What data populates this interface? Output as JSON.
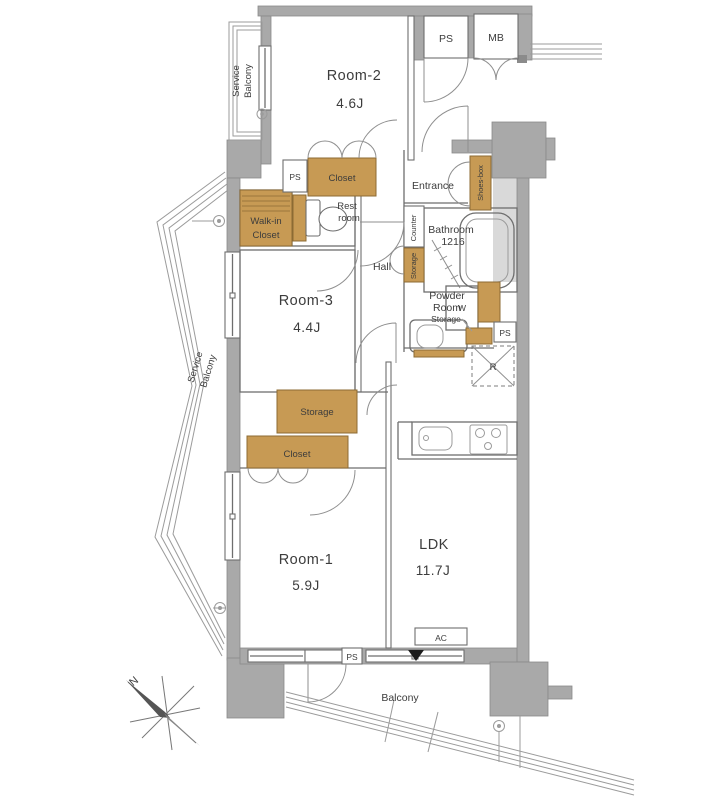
{
  "app": {
    "type": "apartment-floor-plan"
  },
  "colors": {
    "wall": "#a9a9a9",
    "wallStroke": "#8a8a8a",
    "line": "#6e6e6e",
    "fixture": "#c79a54",
    "fixtureStroke": "#8c6b33",
    "exterior": "#d9d9d9",
    "text": "#3c3c3c"
  },
  "labels": {
    "service_balcony_top_l1": "Service",
    "service_balcony_top_l2": "Balcony",
    "room2_name": "Room-2",
    "room2_size": "4.6J",
    "ps_top": "PS",
    "mb": "MB",
    "ps_upper": "PS",
    "closet_top": "Closet",
    "entrance": "Entrance",
    "shoes_box": "Shoes-box",
    "walk_in_closet_l1": "Walk-in",
    "walk_in_closet_l2": "Closet",
    "rest_room_l1": "Rest",
    "rest_room_l2": "room",
    "counter": "Counter",
    "storage_hall": "Storage",
    "bathroom_l1": "Bathroom",
    "bathroom_l2": "1216",
    "hall": "Hall",
    "room3_name": "Room-3",
    "room3_size": "4.4J",
    "powder_room_l1": "Powder",
    "powder_room_l2": "Room",
    "washer": "W",
    "storage_powder": "Storage",
    "ps_right": "PS",
    "fridge": "R",
    "service_balcony_left_l1": "Service",
    "service_balcony_left_l2": "Balcony",
    "storage_main": "Storage",
    "closet_room1": "Closet",
    "room1_name": "Room-1",
    "room1_size": "5.9J",
    "ldk_name": "LDK",
    "ldk_size": "11.7J",
    "ac": "AC",
    "ps_bottom": "PS",
    "balcony": "Balcony",
    "compass_north": "N"
  }
}
